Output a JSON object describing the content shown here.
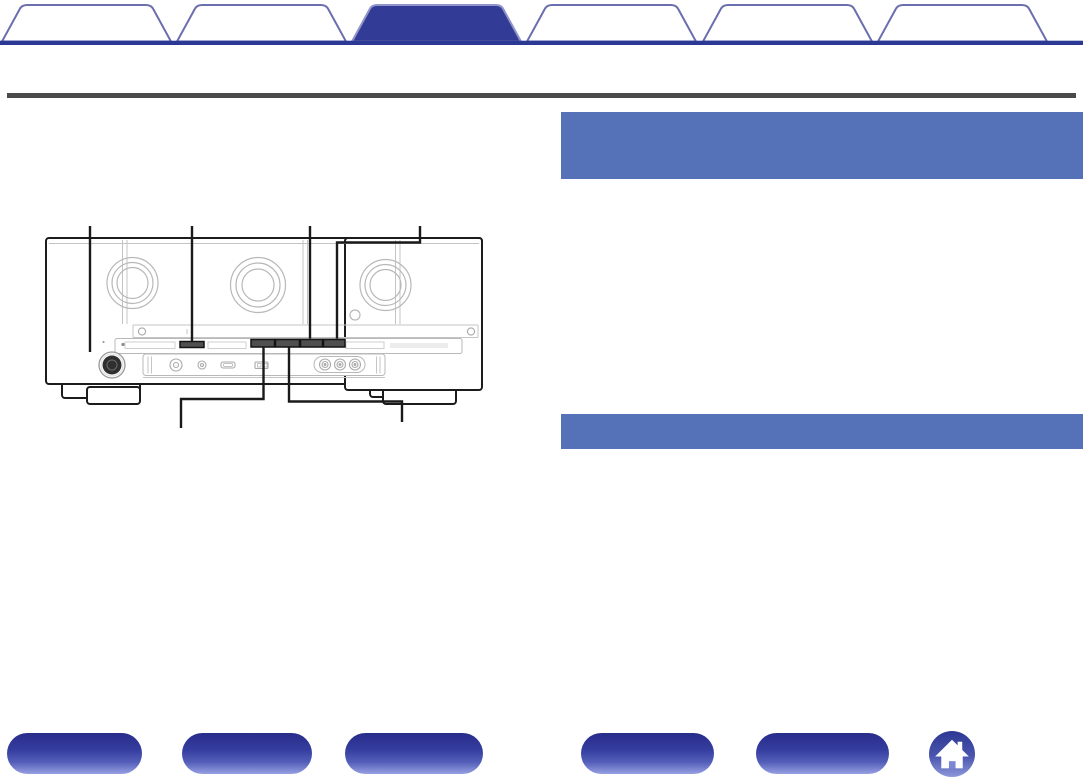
{
  "window": {
    "width": 1083,
    "height": 779,
    "background": "#ffffff"
  },
  "tab_bar": {
    "tabs": [
      {
        "label": "",
        "active": false
      },
      {
        "label": "",
        "active": false
      },
      {
        "label": "",
        "active": true
      },
      {
        "label": "",
        "active": false
      },
      {
        "label": "",
        "active": false
      },
      {
        "label": "",
        "active": false
      }
    ],
    "colors": {
      "baseline": "#2c3994",
      "active_fill": "#323c96",
      "inactive_fill": "#ffffff",
      "border": "#6b6fae",
      "active_border": "#9094c8"
    }
  },
  "divider_rule": {
    "color": "#4a4a4a"
  },
  "content": {
    "headings": [
      {
        "title": "",
        "bg": "#5571b7",
        "height": "tall"
      },
      {
        "title": "",
        "bg": "#5571b7",
        "height": "single"
      }
    ],
    "diagram": {
      "type": "av-receiver-front-panel-line-art",
      "parts": [
        {
          "name": "power-button",
          "callout_label": ""
        },
        {
          "name": "display-button-left",
          "callout_label": ""
        },
        {
          "name": "display-button-mid",
          "callout_label": ""
        },
        {
          "name": "display-button-right",
          "callout_label": ""
        },
        {
          "name": "lower-button-left",
          "callout_label": ""
        },
        {
          "name": "lower-button-right",
          "callout_label": ""
        }
      ]
    }
  },
  "footer": {
    "nav_buttons": [
      {
        "label": ""
      },
      {
        "label": ""
      },
      {
        "label": ""
      },
      {
        "label": ""
      },
      {
        "label": ""
      }
    ],
    "home_button": {
      "icon": "home-icon"
    },
    "colors": {
      "pill_top": "#282c8a",
      "pill_bottom": "#97a0e2",
      "home_top": "#2e3894",
      "home_bottom": "#8c98da"
    }
  }
}
